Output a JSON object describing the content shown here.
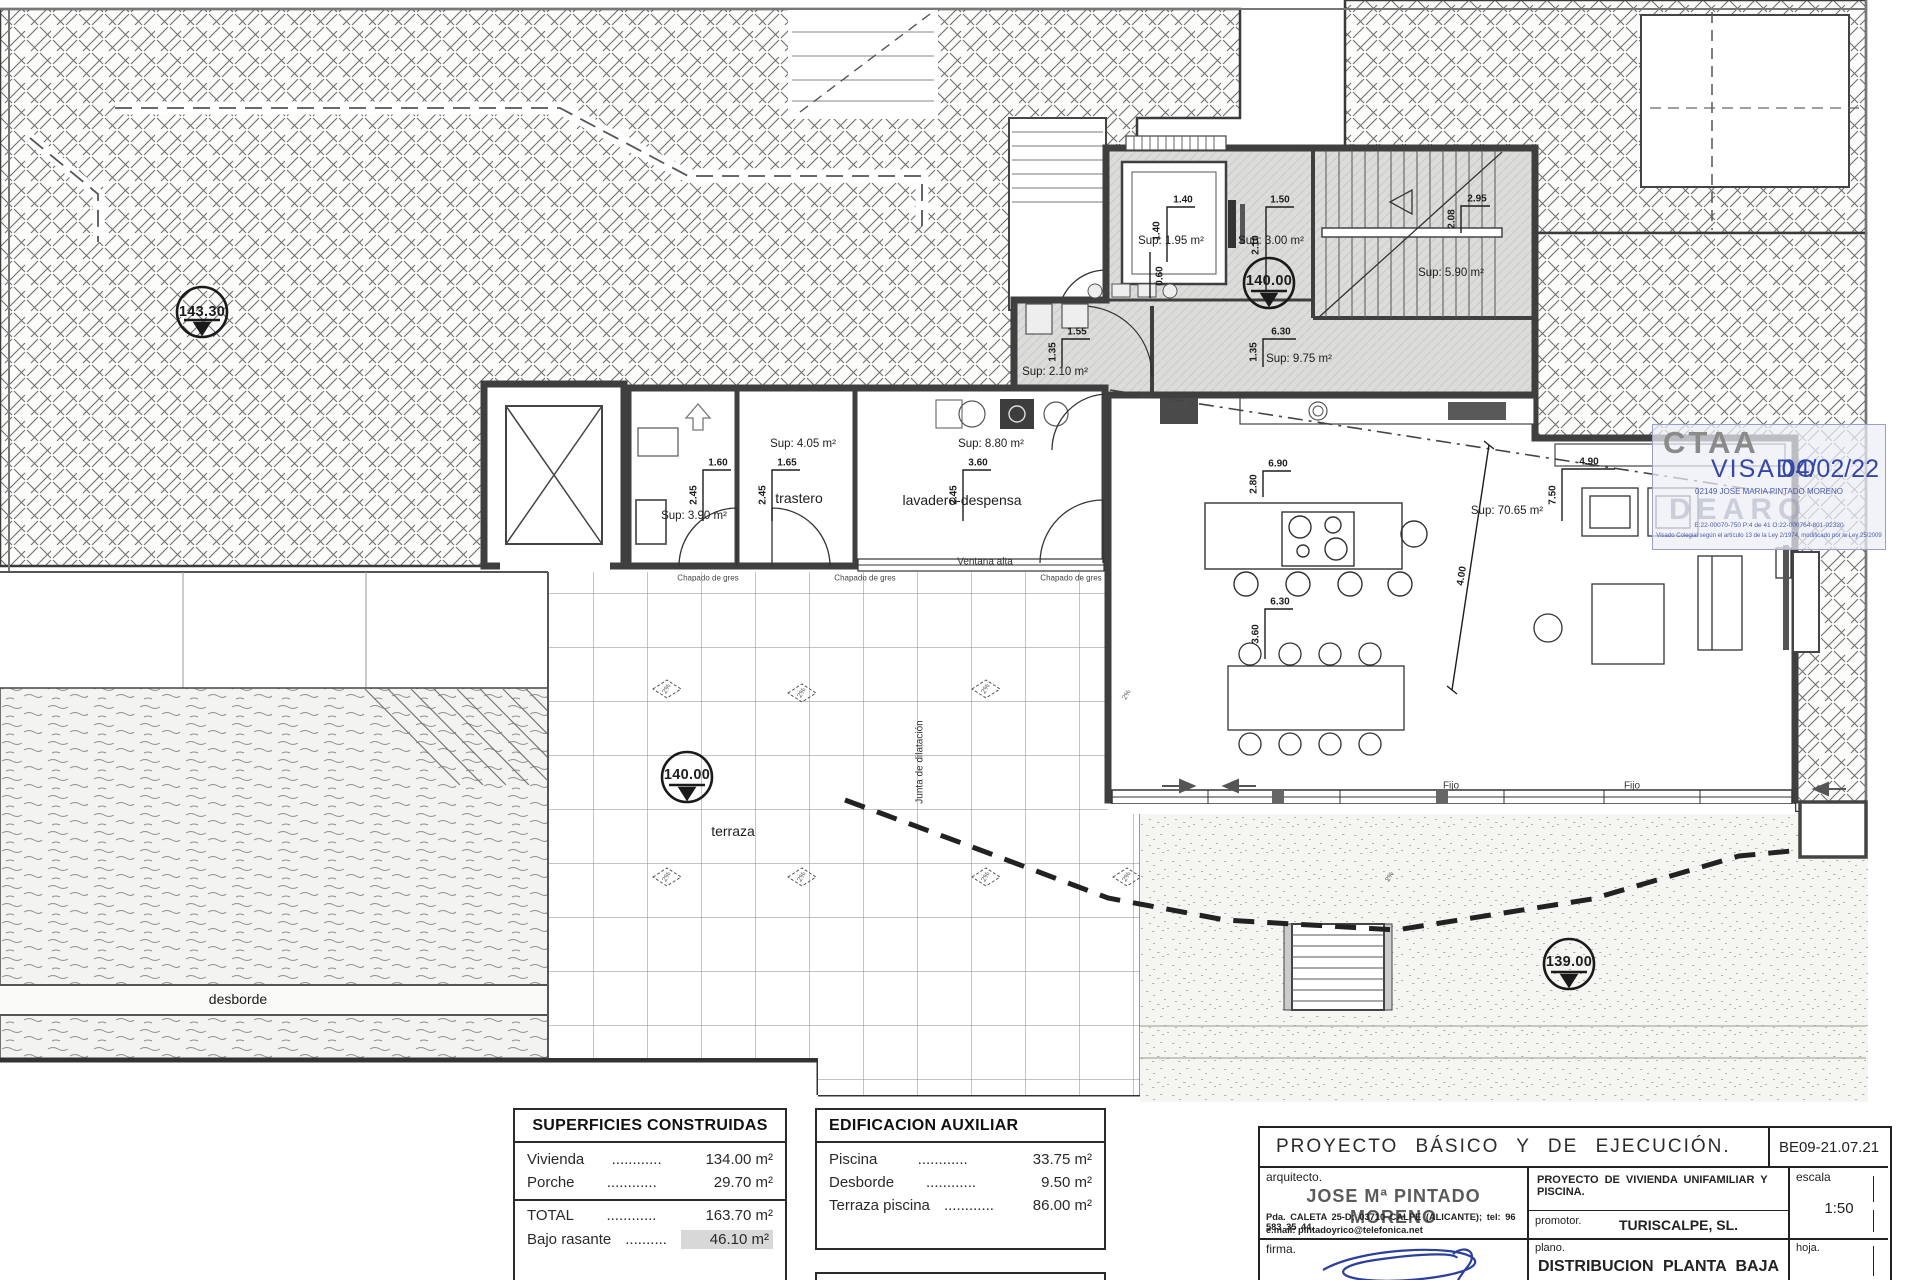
{
  "annotations": [
    {
      "t": "143.30",
      "x": 202,
      "y": 312,
      "c": "marker",
      "n": "level-marker-143-30"
    },
    {
      "t": "140.00",
      "x": 1269,
      "y": 281,
      "c": "marker",
      "n": "level-marker-140-hall"
    },
    {
      "t": "140.00",
      "x": 687,
      "y": 775,
      "c": "marker",
      "n": "level-marker-140-terrace"
    },
    {
      "t": "139.00",
      "x": 1569,
      "y": 962,
      "c": "marker",
      "n": "level-marker-139"
    },
    {
      "t": "Sup: 1.95 m²",
      "x": 1171,
      "y": 241,
      "c": "sup",
      "n": "area-label-elevator"
    },
    {
      "t": "1.40",
      "x": 1183,
      "y": 200,
      "c": "dim"
    },
    {
      "t": "1.40",
      "x": 1157,
      "y": 231,
      "c": "dim",
      "r": -90
    },
    {
      "t": "Sup: 3.00 m²",
      "x": 1271,
      "y": 241,
      "c": "sup",
      "n": "area-label-hall"
    },
    {
      "t": "1.50",
      "x": 1280,
      "y": 200,
      "c": "dim"
    },
    {
      "t": "2.10",
      "x": 1256,
      "y": 245,
      "c": "dim",
      "r": -90
    },
    {
      "t": "Sup: 5.90 m²",
      "x": 1451,
      "y": 273,
      "c": "sup",
      "n": "area-label-stairs"
    },
    {
      "t": "2.95",
      "x": 1477,
      "y": 199,
      "c": "dim"
    },
    {
      "t": "2.08",
      "x": 1452,
      "y": 219,
      "c": "dim",
      "r": -90
    },
    {
      "t": "Sup: 9.75 m²",
      "x": 1299,
      "y": 359,
      "c": "sup",
      "n": "area-label-corridor"
    },
    {
      "t": "6.30",
      "x": 1281,
      "y": 332,
      "c": "dim"
    },
    {
      "t": "1.35",
      "x": 1254,
      "y": 352,
      "c": "dim",
      "r": -90
    },
    {
      "t": "Sup: 2.10 m²",
      "x": 1055,
      "y": 372,
      "c": "sup",
      "n": "area-label-laundry"
    },
    {
      "t": "1.55",
      "x": 1077,
      "y": 332,
      "c": "dim"
    },
    {
      "t": "1.35",
      "x": 1053,
      "y": 352,
      "c": "dim",
      "r": -90
    },
    {
      "t": "0.60",
      "x": 1160,
      "y": 276,
      "c": "dim",
      "r": -90
    },
    {
      "t": "Sup: 3.90 m²",
      "x": 694,
      "y": 516,
      "c": "sup",
      "n": "area-label-bath"
    },
    {
      "t": "1.60",
      "x": 718,
      "y": 463,
      "c": "dim"
    },
    {
      "t": "2.45",
      "x": 694,
      "y": 495,
      "c": "dim",
      "r": -90
    },
    {
      "t": "trastero",
      "x": 799,
      "y": 498,
      "c": "room",
      "n": "room-label-trastero"
    },
    {
      "t": "Sup: 4.05 m²",
      "x": 803,
      "y": 444,
      "c": "sup",
      "n": "area-label-trastero"
    },
    {
      "t": "1.65",
      "x": 787,
      "y": 463,
      "c": "dim"
    },
    {
      "t": "2.45",
      "x": 763,
      "y": 495,
      "c": "dim",
      "r": -90
    },
    {
      "t": "lavadero-despensa",
      "x": 962,
      "y": 500,
      "c": "room",
      "n": "room-label-lavadero"
    },
    {
      "t": "Sup: 8.80 m²",
      "x": 991,
      "y": 444,
      "c": "sup",
      "n": "area-label-lavadero"
    },
    {
      "t": "3.60",
      "x": 978,
      "y": 463,
      "c": "dim"
    },
    {
      "t": "2.45",
      "x": 954,
      "y": 495,
      "c": "dim",
      "r": -90
    },
    {
      "t": "Ventana alta",
      "x": 985,
      "y": 562,
      "c": "small",
      "n": "window-label-ventana-alta"
    },
    {
      "t": "Chapado de gres",
      "x": 708,
      "y": 578,
      "c": "tiny"
    },
    {
      "t": "Chapado de gres",
      "x": 865,
      "y": 578,
      "c": "tiny"
    },
    {
      "t": "Chapado de gres",
      "x": 1071,
      "y": 578,
      "c": "tiny"
    },
    {
      "t": "Sup: 70.65 m²",
      "x": 1507,
      "y": 511,
      "c": "sup",
      "n": "area-label-living"
    },
    {
      "t": "6.90",
      "x": 1278,
      "y": 464,
      "c": "dim"
    },
    {
      "t": "2.80",
      "x": 1254,
      "y": 484,
      "c": "dim",
      "r": -90
    },
    {
      "t": "6.30",
      "x": 1280,
      "y": 602,
      "c": "dim"
    },
    {
      "t": "3.60",
      "x": 1256,
      "y": 634,
      "c": "dim",
      "r": -90
    },
    {
      "t": "4.00",
      "x": 1462,
      "y": 576,
      "c": "dim",
      "r": -81
    },
    {
      "t": "7.50",
      "x": 1553,
      "y": 495,
      "c": "dim",
      "r": -90
    },
    {
      "t": "4.90",
      "x": 1589,
      "y": 462,
      "c": "dim"
    },
    {
      "t": "terraza",
      "x": 733,
      "y": 831,
      "c": "room",
      "n": "room-label-terraza"
    },
    {
      "t": "desborde",
      "x": 238,
      "y": 999,
      "c": "room",
      "n": "room-label-desborde"
    },
    {
      "t": "Junta de dilatación",
      "x": 920,
      "y": 762,
      "c": "small",
      "r": -90,
      "n": "joint-label"
    },
    {
      "t": "Fijo",
      "x": 1451,
      "y": 786,
      "c": "small",
      "n": "window-label-fijo"
    },
    {
      "t": "Fijo",
      "x": 1632,
      "y": 786,
      "c": "small",
      "n": "window-label-fijo"
    },
    {
      "t": "2%",
      "x": 667,
      "y": 689,
      "c": "pct",
      "r": -60
    },
    {
      "t": "2%",
      "x": 802,
      "y": 693,
      "c": "pct",
      "r": -60
    },
    {
      "t": "2%",
      "x": 986,
      "y": 689,
      "c": "pct",
      "r": -60
    },
    {
      "t": "2%",
      "x": 1127,
      "y": 695,
      "c": "pct",
      "r": -60
    },
    {
      "t": "2%",
      "x": 667,
      "y": 877,
      "c": "pct",
      "r": -60
    },
    {
      "t": "2%",
      "x": 802,
      "y": 877,
      "c": "pct",
      "r": -60
    },
    {
      "t": "2%",
      "x": 986,
      "y": 877,
      "c": "pct",
      "r": -60
    },
    {
      "t": "2%",
      "x": 1127,
      "y": 877,
      "c": "pct",
      "r": -60
    },
    {
      "t": "2%",
      "x": 1390,
      "y": 877,
      "c": "pct",
      "r": -60
    }
  ],
  "stamp": {
    "org": "CTAA",
    "visado": "VISADO",
    "date": "04/02/22",
    "line": "02149 JOSE MARIA PINTADO MORENO",
    "watermark": "DEARQ",
    "codes": "E:22-00070-750      P:4 de 41      O:22-000764-801-02320",
    "legal": "Visado Colegial según el artículo 13 de la Ley 2/1974, modificado por la Ley 25/2009"
  },
  "superficies": {
    "title": "SUPERFICIES CONSTRUIDAS",
    "rows": [
      {
        "l": "Vivienda",
        "d": "............",
        "v": "134.00 m²"
      },
      {
        "l": "Porche",
        "d": "............",
        "v": "29.70 m²"
      }
    ],
    "totals": [
      {
        "l": "TOTAL",
        "d": "............",
        "v": "163.70 m²"
      },
      {
        "l": "Bajo rasante",
        "d": "..........",
        "v": "46.10 m²"
      }
    ]
  },
  "auxiliar": {
    "title": "EDIFICACION AUXILIAR",
    "rows": [
      {
        "l": "Piscina",
        "d": "............",
        "v": "33.75 m²"
      },
      {
        "l": "Desborde",
        "d": "............",
        "v": "9.50 m²"
      },
      {
        "l": "Terraza piscina",
        "d": "............",
        "v": "86.00 m²"
      }
    ]
  },
  "titleblock": {
    "title": "PROYECTO BÁSICO Y DE EJECUCIÓN.",
    "ref": "BE09-21.07.21",
    "arquitecto_label": "arquitecto.",
    "architect": "JOSE Mª PINTADO MORENO",
    "address": "Pda. CALETA 25-D; 03710 CALPE (ALICANTE); tel: 96 583 35 44.",
    "email": "e.mail: pintadoyrico@telefonica.net",
    "firma_label": "firma.",
    "project": "PROYECTO DE VIVIENDA UNIFAMILIAR Y PISCINA.",
    "promotor_label": "promotor.",
    "promotor": "TURISCALPE, SL.",
    "escala_label": "escala",
    "escala": "1:50",
    "plano_label": "plano.",
    "plano": "DISTRIBUCION PLANTA BAJA",
    "hoja_label": "hoja."
  },
  "colors": {
    "stamp_blue": "#3547a8",
    "wall_gray": "#3f3f3f",
    "floor_gray": "#dcdcda",
    "signature_blue": "#2b3f9e"
  }
}
